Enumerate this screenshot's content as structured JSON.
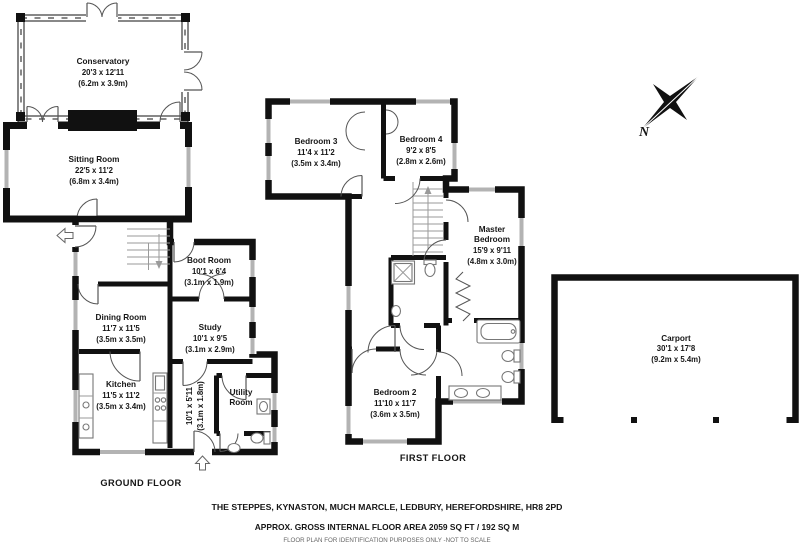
{
  "colors": {
    "wall": "#111111",
    "window": "#b3b3b3",
    "text": "#161616"
  },
  "compass": {
    "north_label": "N"
  },
  "ground_floor": {
    "label": "GROUND FLOOR",
    "conservatory": {
      "name": "Conservatory",
      "ft": "20'3 x 12'11",
      "m": "(6.2m x 3.9m)"
    },
    "sitting_room": {
      "name": "Sitting  Room",
      "ft": "22'5 x 11'2",
      "m": "(6.8m x 3.4m)"
    },
    "boot_room": {
      "name": "Boot Room",
      "ft": "10'1 x 6'4",
      "m": "(3.1m x 1.9m)"
    },
    "dining_room": {
      "name": "Dining Room",
      "ft": "11'7 x 11'5",
      "m": "(3.5m x 3.5m)"
    },
    "study": {
      "name": "Study",
      "ft": "10'1 x 9'5",
      "m": "(3.1m x 2.9m)"
    },
    "kitchen": {
      "name": "Kitchen",
      "ft": "11'5 x 11'2",
      "m": "(3.5m x 3.4m)"
    },
    "hall": {
      "ft": "10'1 x 5'11",
      "m": "(3.1m x 1.8m)"
    },
    "utility": {
      "name_line1": "Utility",
      "name_line2": "Room"
    }
  },
  "first_floor": {
    "label": "FIRST FLOOR",
    "bedroom3": {
      "name": "Bedroom 3",
      "ft": "11'4 x 11'2",
      "m": "(3.5m x 3.4m)"
    },
    "bedroom4": {
      "name": "Bedroom 4",
      "ft": "9'2 x 8'5",
      "m": "(2.8m x 2.6m)"
    },
    "master_bedroom": {
      "name_line1": "Master",
      "name_line2": "Bedroom",
      "ft": "15'9 x 9'11",
      "m": "(4.8m x 3.0m)"
    },
    "bedroom2": {
      "name": "Bedroom 2",
      "ft": "11'10 x 11'7",
      "m": "(3.6m x 3.5m)"
    }
  },
  "carport": {
    "name": "Carport",
    "ft": "30'1 x 17'8",
    "m": "(9.2m x 5.4m)"
  },
  "title_block": {
    "address": "THE STEPPES, KYNASTON, MUCH MARCLE, LEDBURY, HEREFORDSHIRE, HR8 2PD",
    "area": "APPROX. GROSS INTERNAL FLOOR AREA 2059 SQ FT / 192 SQ M",
    "disclaimer": "FLOOR PLAN FOR IDENTIFICATION PURPOSES ONLY -NOT TO SCALE"
  }
}
